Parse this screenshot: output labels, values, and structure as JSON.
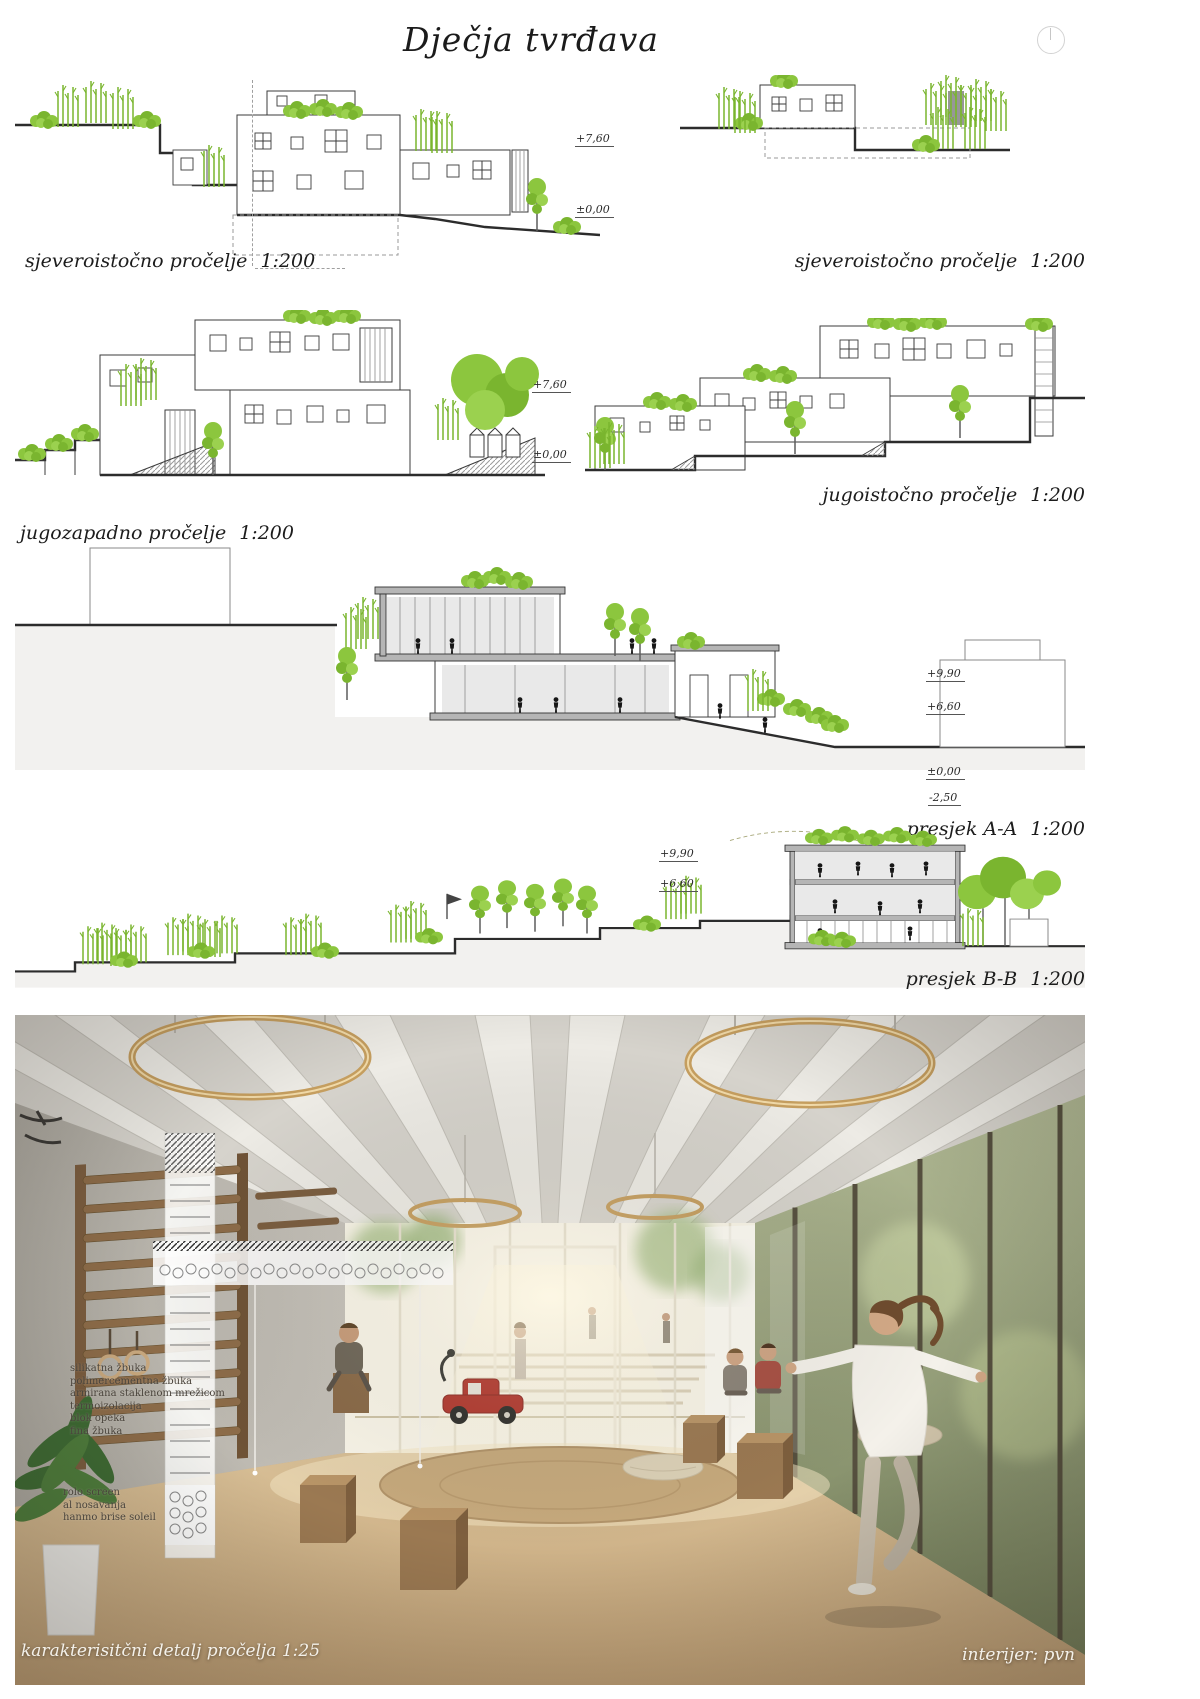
{
  "title": "Dječja tvrđava",
  "panels": {
    "ne_left": {
      "name": "sjeveroistočno pročelje",
      "scale": "1:200",
      "levels": [
        "+7,60",
        "±0,00"
      ]
    },
    "ne_right": {
      "name": "sjeveroistočno pročelje",
      "scale": "1:200"
    },
    "sw": {
      "name": "jugozapadno pročelje",
      "scale": "1:200",
      "levels": [
        "+7,60",
        "±0,00"
      ]
    },
    "se": {
      "name": "jugoistočno pročelje",
      "scale": "1:200"
    },
    "sec_a": {
      "name": "presjek A-A",
      "scale": "1:200",
      "levels": [
        "+9,90",
        "+6,60",
        "±0,00",
        "-2,50"
      ]
    },
    "sec_b": {
      "name": "presjek B-B",
      "scale": "1:200",
      "levels": [
        "+9,90",
        "+6,60"
      ]
    }
  },
  "photo": {
    "facade_layer_notes": [
      "silikatna žbuka",
      "polimercementna žbuka",
      "armirana staklenom mrežicom",
      "termoizolacija",
      "blok opeka",
      "fina žbuka"
    ],
    "shading_notes": [
      "rolo screen",
      "al nosavanja",
      "hanmo brise soleil"
    ],
    "caption_detail": "karakterisitčni detalj pročelja 1:25",
    "caption_interior": "interijer: pvn"
  },
  "icons": {
    "compass": "north-indicator"
  },
  "colors": {
    "vegetation": "#8CC63E",
    "vegetation_dark": "#7AB52F",
    "ink": "#3B3B3B",
    "section_fill": "#B5B5B5",
    "ring_light": "#C59E5F"
  }
}
